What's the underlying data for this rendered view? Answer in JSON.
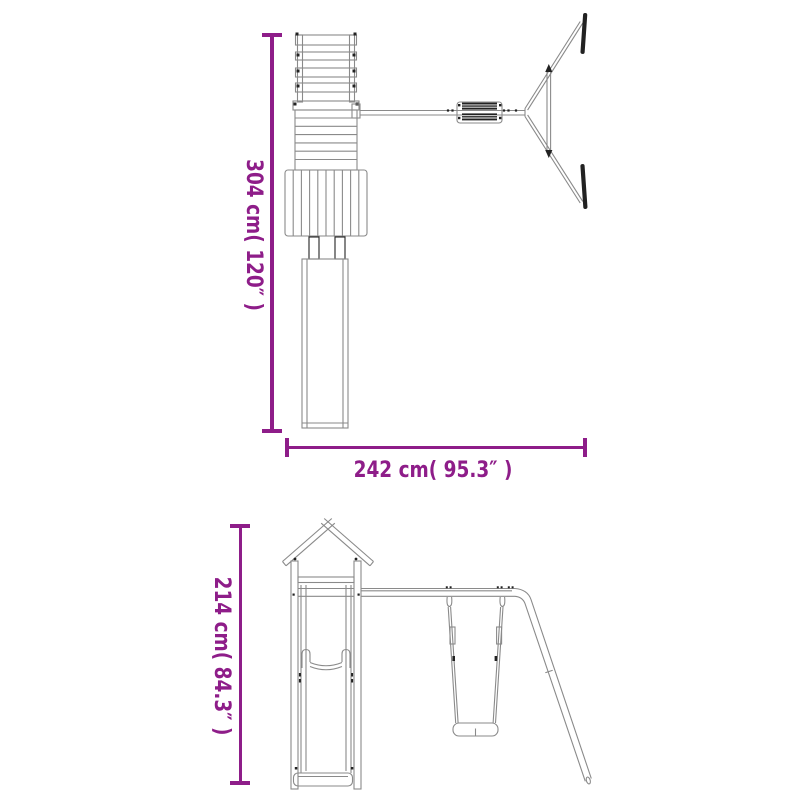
{
  "colors": {
    "accent": "#8e1d89",
    "line": "#8a8a8a",
    "dark": "#222222",
    "background": "#ffffff"
  },
  "plan_view": {
    "name": "playhouse-with-swing-set-top-view",
    "height_dimension": "304 cm( 120″ )",
    "width_dimension": "242 cm( 95.3″ )"
  },
  "side_view": {
    "name": "playhouse-with-swing-set-side-view",
    "height_dimension": "214 cm( 84.3″ )"
  }
}
